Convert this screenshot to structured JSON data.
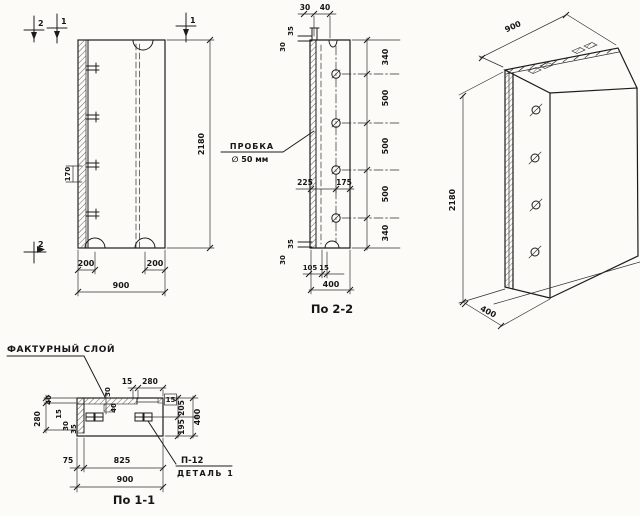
{
  "colors": {
    "paper": "#fcfbf8",
    "ink": "#1c1c1c"
  },
  "front_view": {
    "mark_2_top": "2",
    "mark_1_top": "1",
    "mark_1_right": "1",
    "mark_2_bottom": "2",
    "dim_170": "170",
    "dim_200_left": "200",
    "dim_200_right": "200",
    "dim_900": "900",
    "dim_2180": "2180"
  },
  "section_2_2": {
    "caption": "По 2-2",
    "dim_30_top": "30",
    "dim_40_top": "40",
    "dim_35_upper_left": "35",
    "dim_30_upper_left": "30",
    "dim_35_lower_left": "35",
    "dim_30_lower_left": "30",
    "right_dims": [
      "340",
      "500",
      "500",
      "500",
      "340"
    ],
    "plug_label": "ПРОБКА",
    "plug_diameter": "∅ 50 мм",
    "dim_225": "225",
    "dim_175": "175",
    "dim_105": "105",
    "dim_15": "15",
    "dim_400": "400"
  },
  "isometric_view": {
    "dim_900": "900",
    "dim_2180": "2180",
    "dim_400": "400"
  },
  "section_1_1": {
    "caption": "По 1-1",
    "texture_layer_label": "ФАКТУРНЫЙ СЛОЙ",
    "detail_code": "П-12",
    "detail_label": "ДЕТАЛЬ 1",
    "dim_15_top": "15",
    "dim_280_top": "280",
    "dim_30_key": "30",
    "dim_40_key": "40",
    "dim_15_end": "15",
    "dim_40_left": "40",
    "dim_280_left": "280",
    "dim_15_inner": "15",
    "dim_30_inner": "30",
    "dim_35_inner": "35",
    "dim_205": "205",
    "dim_195": "195",
    "dim_400": "400",
    "dim_75": "75",
    "dim_825": "825",
    "dim_900": "900"
  }
}
